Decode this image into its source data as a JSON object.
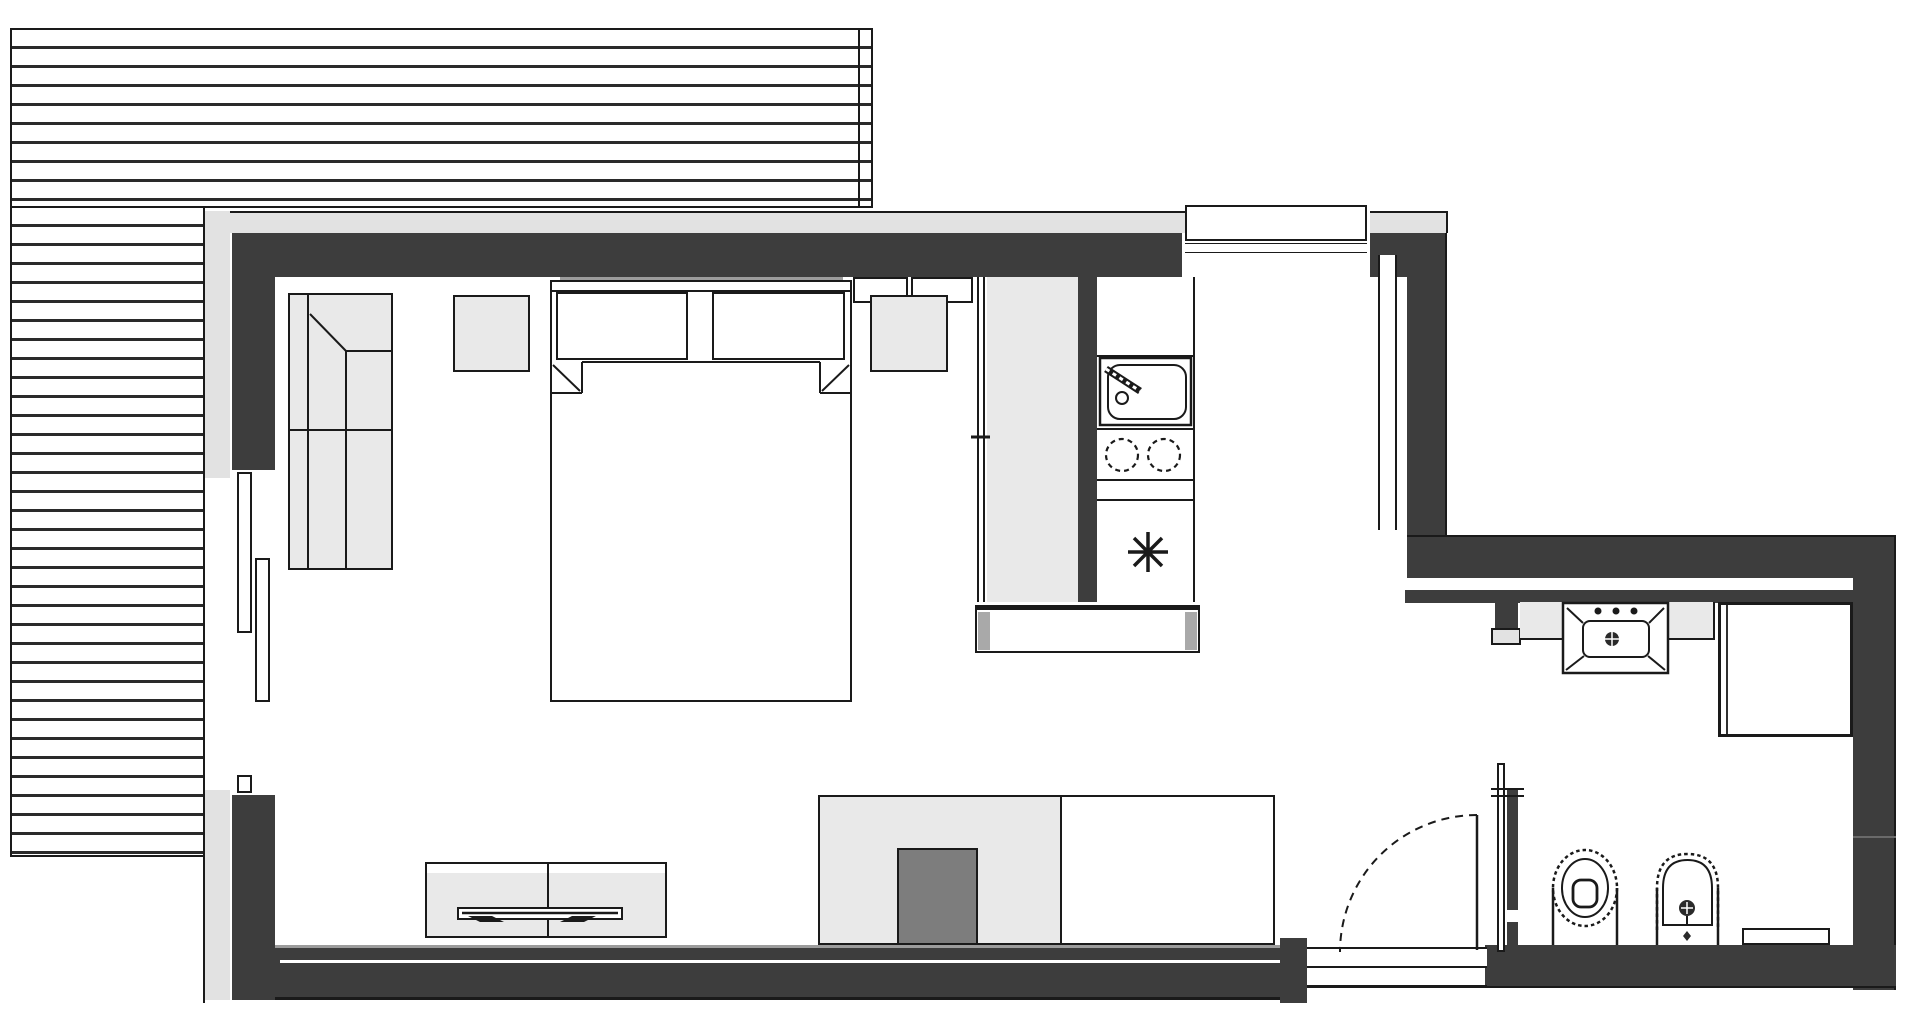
{
  "meta": {
    "kind": "architectural-floor-plan",
    "style": "black-and-white line drawing, top-down view, no text labels",
    "canvas": {
      "width": 1920,
      "height": 1024
    }
  },
  "palette": {
    "paper": "#ffffff",
    "wall": "#3d3d3d",
    "band": "#e2e2e2",
    "furn": "#e9e9e9",
    "glaz": "#9c9c9c",
    "dark": "#7d7d7d",
    "ink": "#1a1a1a",
    "deckline": "#2a2a2a",
    "capgray": "#a9a9a9"
  },
  "deck": {
    "description": "wooden terrace with horizontal slats wrapping top and left of the unit",
    "slat_spacing_px": 19
  },
  "rooms": {
    "bedroom_living": {
      "fixtures": [
        "corner-sofa",
        "nightstand-left",
        "double-bed",
        "nightstand-right",
        "sliding-terrace-doors",
        "tv-sideboard",
        "tv",
        "sofa-bench",
        "coffee-block"
      ]
    },
    "kitchen": {
      "fixtures": [
        "tall-partition",
        "sink-with-faucet",
        "two-burner-cooktop",
        "appliance-with-star-symbol",
        "counter-desk"
      ]
    },
    "hall": {
      "fixtures": [
        "entry-window",
        "duct-strip",
        "entrance-door-swing",
        "threshold"
      ]
    },
    "bathroom": {
      "fixtures": [
        "vanity-counter",
        "washbasin",
        "shower-enclosure",
        "toilet",
        "bidet",
        "radiator",
        "pocket-door"
      ]
    }
  }
}
